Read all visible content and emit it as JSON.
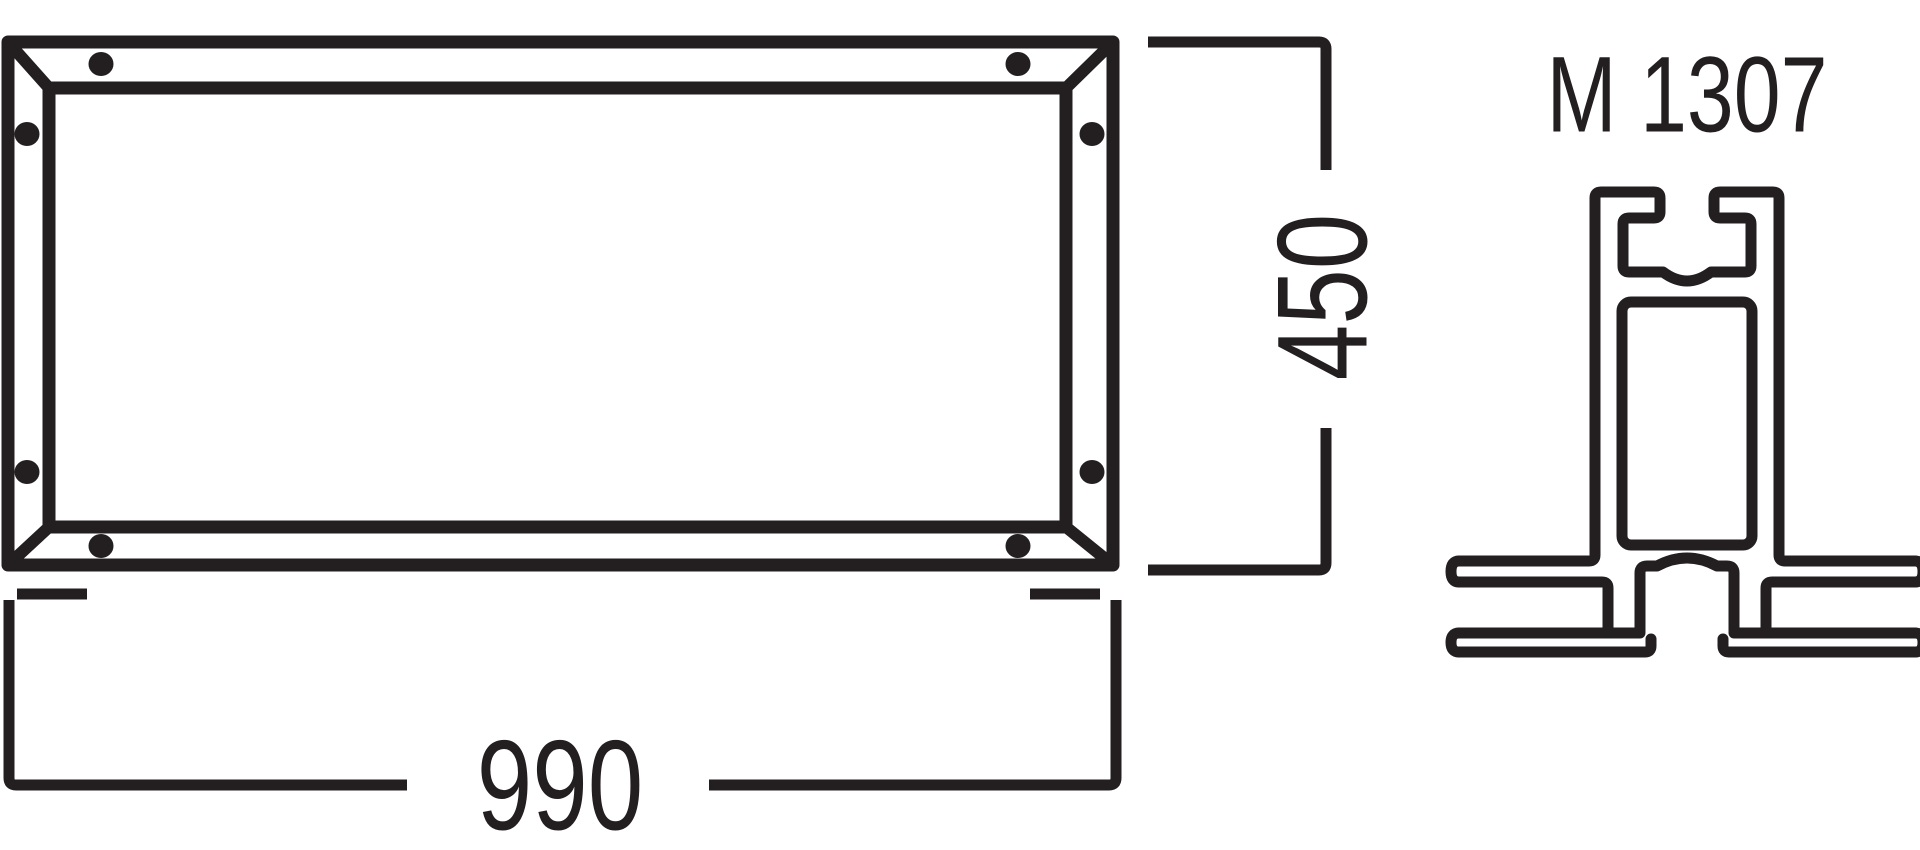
{
  "drawing": {
    "type": "technical-dimension-drawing",
    "ink_color": "#231f20",
    "background_color": "#ffffff"
  },
  "front_view": {
    "description": "rectangular frame front view with mitered corners and screw dots"
  },
  "dimensions": {
    "width": {
      "value": "990"
    },
    "height": {
      "value": "450"
    }
  },
  "profile": {
    "label": "M 1307"
  }
}
